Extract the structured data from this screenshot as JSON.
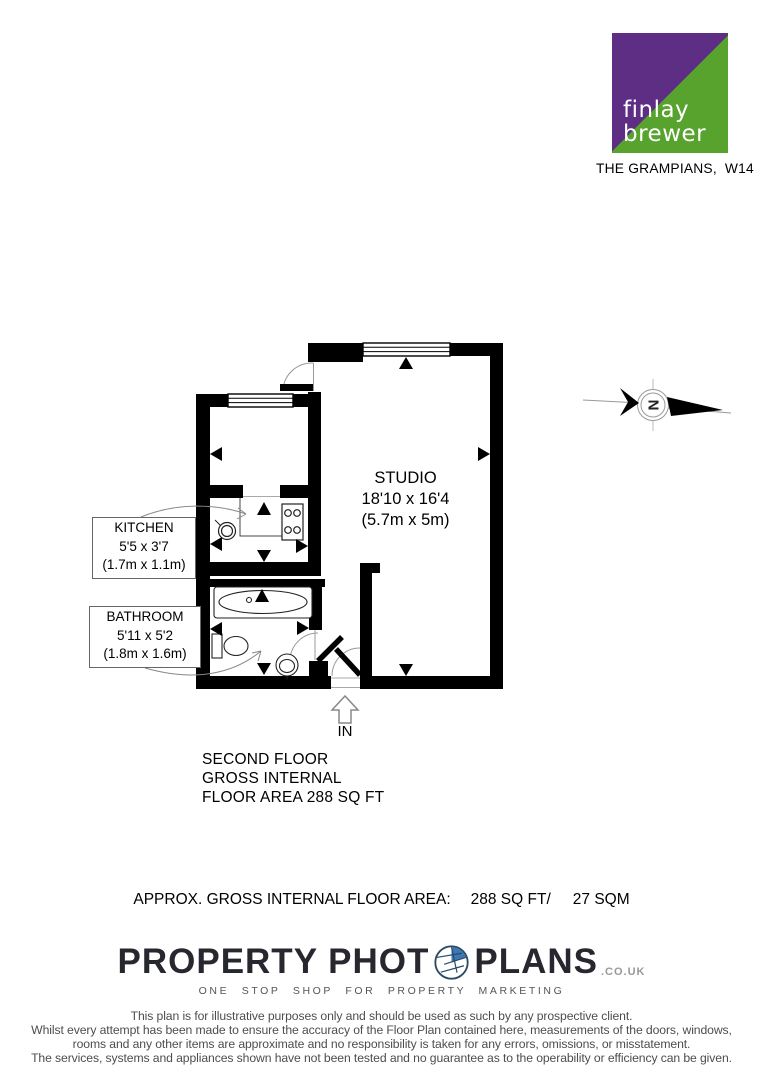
{
  "branding": {
    "logo": {
      "line1": "finlay",
      "line2": "brewer",
      "purple": "#5e2d84",
      "green": "#57a32e"
    },
    "address": "THE GRAMPIANS,  W14"
  },
  "plan": {
    "studio": {
      "name": "STUDIO",
      "imperial": "18'10 x 16'4",
      "metric": "(5.7m x 5m)"
    },
    "kitchen": {
      "name": "KITCHEN",
      "imperial": "5'5 x 3'7",
      "metric": "(1.7m x 1.1m)"
    },
    "bathroom": {
      "name": "BATHROOM",
      "imperial": "5'11 x 5'2",
      "metric": "(1.8m x 1.6m)"
    },
    "entrance": "IN",
    "compass": "N",
    "floor_note": {
      "lines": [
        "SECOND FLOOR",
        "GROSS INTERNAL",
        "FLOOR AREA 288 SQ FT"
      ]
    }
  },
  "summary": {
    "label": "APPROX. GROSS INTERNAL FLOOR AREA:",
    "imperial": "288 SQ FT/",
    "metric": "27 SQM"
  },
  "provider": {
    "name_left": "PROPERTY PHOT",
    "name_right": "PLANS",
    "domain": ".CO.UK",
    "tagline": "ONE STOP SHOP FOR PROPERTY MARKETING",
    "accent_blue": "#3c78b4"
  },
  "disclaimer": {
    "lines": [
      "This plan is for illustrative purposes only and should be used as such by any prospective client.",
      "Whilst every attempt has been made to ensure the accuracy of the Floor Plan contained here, measurements of the doors, windows,",
      "rooms and any other items are approximate and no responsibility is taken for any errors, omissions, or misstatement.",
      "The services, systems and appliances shown have not been tested and no guarantee as to the operability or efficiency can be given."
    ]
  }
}
